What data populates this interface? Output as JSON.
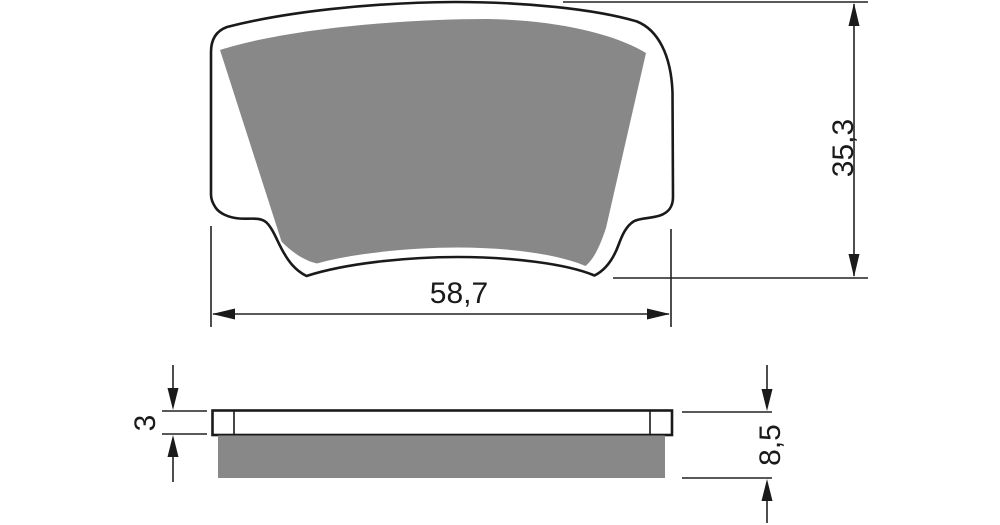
{
  "drawing": {
    "type": "technical-drawing",
    "subject": "brake-pad",
    "colors": {
      "background": "#ffffff",
      "outline": "#1a1a1a",
      "friction_material": "#888888",
      "dimension_lines": "#222222"
    },
    "dimensions": {
      "top_view": {
        "width": "58,7",
        "height": "35,3"
      },
      "side_view": {
        "backplate_thickness": "3",
        "total_thickness": "8,5"
      }
    }
  }
}
